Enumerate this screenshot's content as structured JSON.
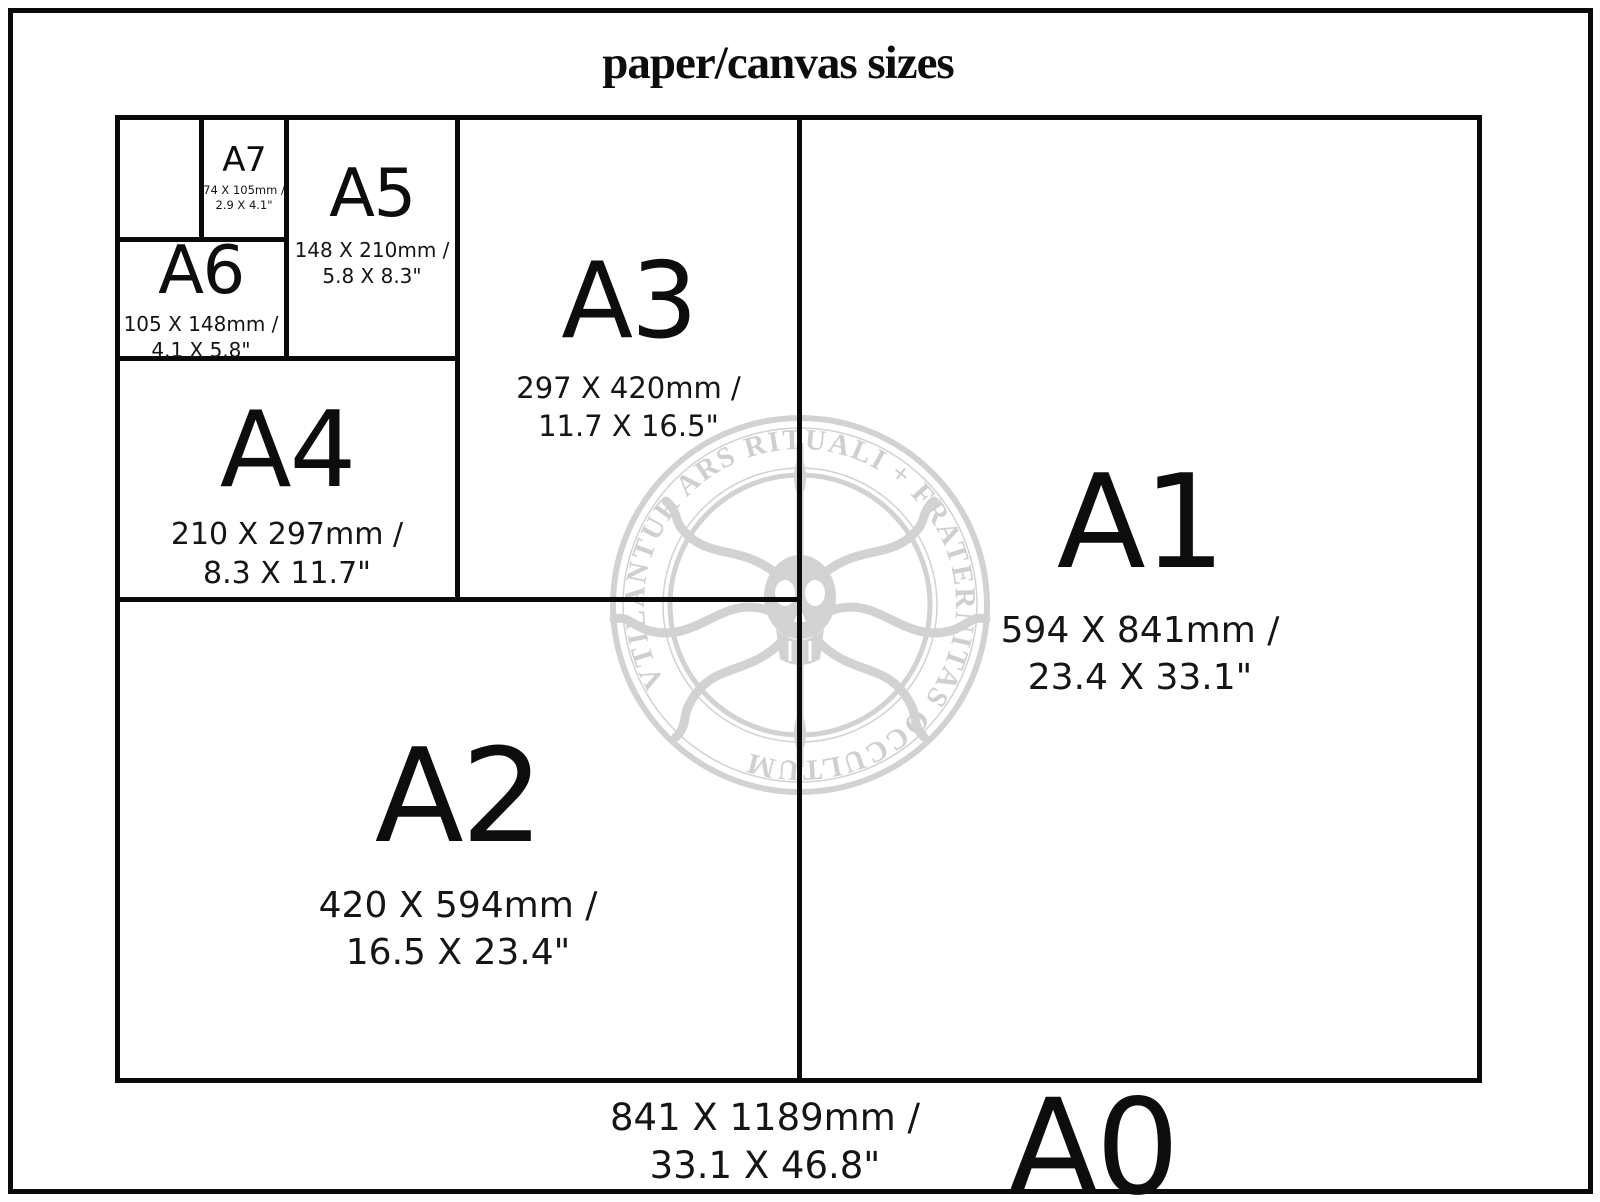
{
  "title": "paper/canvas sizes",
  "watermark": {
    "ring_text": "VTILANTUR ARS RITUALI + FRATERNITAS OCCULTUM"
  },
  "sizes": {
    "a7": {
      "label": "A7",
      "mm": "74 X 105mm /",
      "inches": "2.9 X 4.1\""
    },
    "a6": {
      "label": "A6",
      "mm": "105 X 148mm /",
      "inches": "4.1 X 5.8\""
    },
    "a5": {
      "label": "A5",
      "mm": "148 X 210mm /",
      "inches": "5.8 X 8.3\""
    },
    "a4": {
      "label": "A4",
      "mm": "210 X 297mm /",
      "inches": "8.3 X 11.7\""
    },
    "a3": {
      "label": "A3",
      "mm": "297 X 420mm /",
      "inches": "11.7 X 16.5\""
    },
    "a2": {
      "label": "A2",
      "mm": "420 X 594mm /",
      "inches": "16.5 X 23.4\""
    },
    "a1": {
      "label": "A1",
      "mm": "594 X 841mm /",
      "inches": "23.4 X 33.1\""
    },
    "a0": {
      "label": "A0",
      "mm": "841 X 1189mm /",
      "inches": "33.1 X 46.8\""
    }
  },
  "colors": {
    "line": "#0a0a0a",
    "text": "#151515",
    "watermark": "#d2d2d2",
    "background": "#ffffff"
  }
}
